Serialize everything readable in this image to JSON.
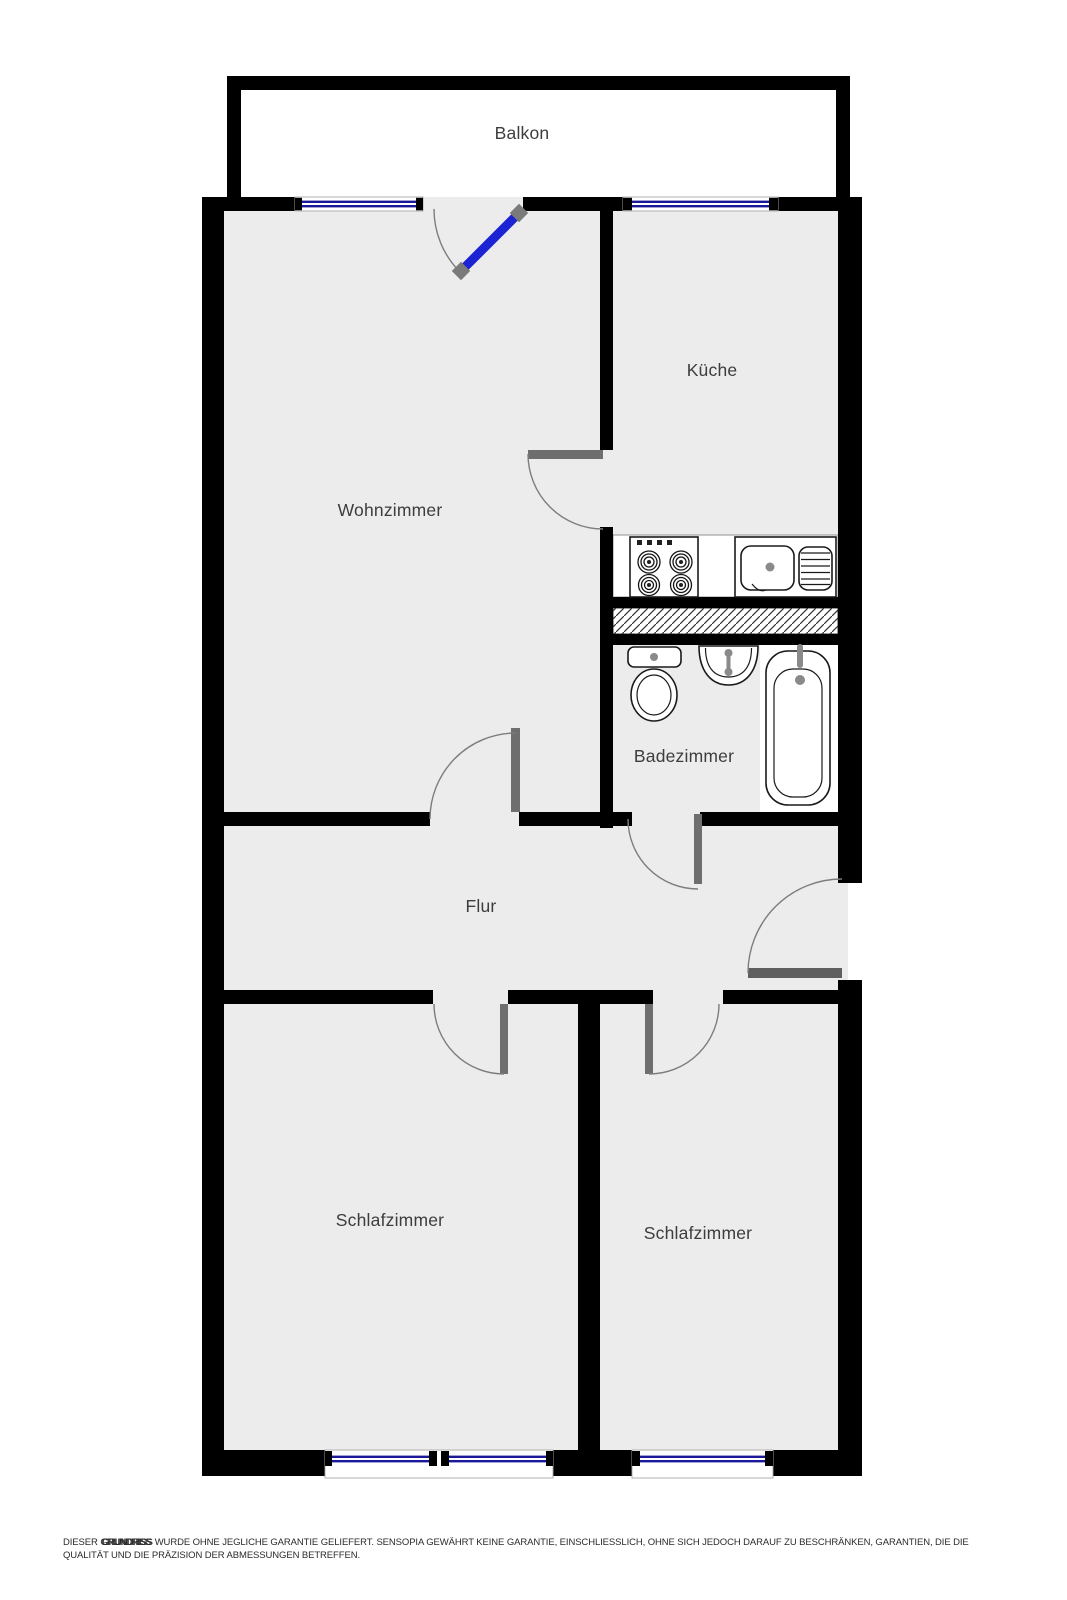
{
  "rooms": {
    "balkon": "Balkon",
    "wohnzimmer": "Wohnzimmer",
    "kueche": "Küche",
    "badezimmer": "Badezimmer",
    "flur": "Flur",
    "schlafzimmer_links": "Schlafzimmer",
    "schlafzimmer_rechts": "Schlafzimmer"
  },
  "disclaimer": {
    "prefix": "DIESER",
    "overlap_word": "GRUNDRISS",
    "line1_rest": "WURDE OHNE JEGLICHE GARANTIE GELIEFERT. SENSOPIA GEWÄHRT KEINE GARANTIE, EINSCHLIESSLICH, OHNE SICH JEDOCH DARAUF ZU BESCHRÄNKEN, GARANTIEN, DIE DIE",
    "line2": "QUALITÄT UND DIE PRÄZISION DER ABMESSUNGEN BETREFFEN."
  },
  "legend_colors": {
    "wall": "#000000",
    "room_fill": "#ececec",
    "window_glass": "#1a1a99",
    "balcony_door": "#1b23d3",
    "door_leaf": "#6e6e6e",
    "swing_arc": "#7d7d7d",
    "label_text": "#3d3d3d",
    "disclaimer_text": "#2b2b2b"
  },
  "fixtures": {
    "stove": "4-burner-cooktop",
    "sink": "kitchen-sink-with-drainboard",
    "toilet": "toilet",
    "washbasin": "washbasin",
    "bathtub": "bathtub",
    "shaft": "hatched-installation-shaft"
  }
}
